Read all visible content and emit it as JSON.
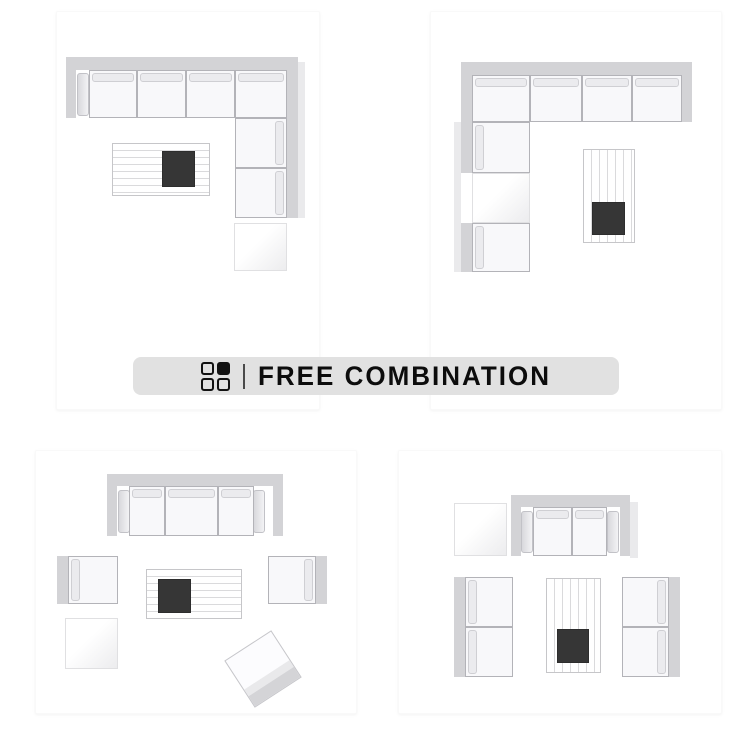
{
  "banner": {
    "label": "FREE COMBINATION",
    "icon": "grid-2x2-icon",
    "bg_color": "#e1e1e1",
    "text_color": "#0c0c0c"
  },
  "palette": {
    "sofa_band": "#d3d3d6",
    "seat_cushion": "#f8f8fa",
    "back_cushion": "#ebebee",
    "tray_dark": "#363636",
    "table_line": "#dadadc",
    "shadow": "#eaeaec"
  },
  "layouts": [
    {
      "id": "layout-top-left",
      "description": "L-shaped sectional (chaise on right) with ottoman and slatted coffee table with dark tray",
      "pieces": [
        {
          "t": "band",
          "x": 66,
          "y": 57,
          "w": 232,
          "h": 13
        },
        {
          "t": "band",
          "x": 66,
          "y": 70,
          "w": 10,
          "h": 48
        },
        {
          "t": "band",
          "x": 287,
          "y": 70,
          "w": 11,
          "h": 148
        },
        {
          "t": "shadow",
          "x": 298,
          "y": 62,
          "w": 7,
          "h": 156
        },
        {
          "t": "arm",
          "x": 77,
          "y": 73,
          "w": 12,
          "h": 43
        },
        {
          "t": "seat",
          "b": "t",
          "x": 89,
          "y": 70,
          "w": 48,
          "h": 48
        },
        {
          "t": "seat",
          "b": "t",
          "x": 137,
          "y": 70,
          "w": 49,
          "h": 48
        },
        {
          "t": "seat",
          "b": "t",
          "x": 186,
          "y": 70,
          "w": 49,
          "h": 48
        },
        {
          "t": "seat",
          "b": "t",
          "x": 235,
          "y": 70,
          "w": 52,
          "h": 48
        },
        {
          "t": "seat",
          "b": "r",
          "x": 235,
          "y": 118,
          "w": 52,
          "h": 50
        },
        {
          "t": "seat",
          "b": "r",
          "x": 235,
          "y": 168,
          "w": 52,
          "h": 50
        },
        {
          "t": "ottoman",
          "x": 234,
          "y": 223,
          "w": 53,
          "h": 48
        },
        {
          "t": "tableh",
          "x": 112,
          "y": 143,
          "w": 98,
          "h": 53
        },
        {
          "t": "tray",
          "x": 162,
          "y": 151,
          "w": 33,
          "h": 36
        }
      ]
    },
    {
      "id": "layout-top-right",
      "description": "Mirrored L-shaped sectional (chaise on left) with inset ottoman and vertical-slat table with dark tray",
      "pieces": [
        {
          "t": "band",
          "x": 461,
          "y": 62,
          "w": 231,
          "h": 13
        },
        {
          "t": "band",
          "x": 682,
          "y": 75,
          "w": 10,
          "h": 47
        },
        {
          "t": "band",
          "x": 461,
          "y": 75,
          "w": 11,
          "h": 98
        },
        {
          "t": "band",
          "x": 461,
          "y": 223,
          "w": 11,
          "h": 49
        },
        {
          "t": "shadow",
          "x": 454,
          "y": 122,
          "w": 7,
          "h": 150
        },
        {
          "t": "arm",
          "x": 668,
          "y": 80,
          "w": 12,
          "h": 40
        },
        {
          "t": "seat",
          "b": "t",
          "x": 472,
          "y": 75,
          "w": 58,
          "h": 47
        },
        {
          "t": "seat",
          "b": "t",
          "x": 530,
          "y": 75,
          "w": 52,
          "h": 47
        },
        {
          "t": "seat",
          "b": "t",
          "x": 582,
          "y": 75,
          "w": 50,
          "h": 47
        },
        {
          "t": "seat",
          "b": "t",
          "x": 632,
          "y": 75,
          "w": 50,
          "h": 47
        },
        {
          "t": "seat",
          "b": "l",
          "x": 472,
          "y": 122,
          "w": 58,
          "h": 51
        },
        {
          "t": "ottoman",
          "x": 472,
          "y": 173,
          "w": 58,
          "h": 50
        },
        {
          "t": "seat",
          "b": "l",
          "x": 472,
          "y": 223,
          "w": 58,
          "h": 49
        },
        {
          "t": "tablev",
          "x": 583,
          "y": 149,
          "w": 52,
          "h": 94
        },
        {
          "t": "tray",
          "x": 592,
          "y": 202,
          "w": 33,
          "h": 33
        }
      ]
    },
    {
      "id": "layout-bottom-left",
      "description": "Three-seat sofa with two facing armchairs, ottoman, rotated accent chair and slatted coffee table",
      "pieces": [
        {
          "t": "band",
          "x": 107,
          "y": 474,
          "w": 176,
          "h": 12
        },
        {
          "t": "band",
          "x": 107,
          "y": 486,
          "w": 10,
          "h": 50
        },
        {
          "t": "band",
          "x": 273,
          "y": 486,
          "w": 10,
          "h": 50
        },
        {
          "t": "arm",
          "x": 118,
          "y": 490,
          "w": 12,
          "h": 43
        },
        {
          "t": "arm",
          "x": 253,
          "y": 490,
          "w": 12,
          "h": 43
        },
        {
          "t": "seat",
          "b": "t",
          "x": 129,
          "y": 486,
          "w": 36,
          "h": 50
        },
        {
          "t": "seat",
          "b": "t",
          "x": 165,
          "y": 486,
          "w": 53,
          "h": 50
        },
        {
          "t": "seat",
          "b": "t",
          "x": 218,
          "y": 486,
          "w": 36,
          "h": 50
        },
        {
          "t": "band",
          "x": 57,
          "y": 556,
          "w": 11,
          "h": 48
        },
        {
          "t": "seat",
          "b": "l",
          "x": 68,
          "y": 556,
          "w": 50,
          "h": 48
        },
        {
          "t": "seat",
          "b": "r",
          "x": 268,
          "y": 556,
          "w": 48,
          "h": 48
        },
        {
          "t": "band",
          "x": 316,
          "y": 556,
          "w": 11,
          "h": 48
        },
        {
          "t": "tableh",
          "x": 146,
          "y": 569,
          "w": 96,
          "h": 50
        },
        {
          "t": "tray",
          "x": 158,
          "y": 579,
          "w": 33,
          "h": 34
        },
        {
          "t": "ottoman",
          "x": 65,
          "y": 618,
          "w": 53,
          "h": 51
        },
        {
          "t": "chairrot",
          "x": 235,
          "y": 641,
          "w": 56,
          "h": 56,
          "r": -33
        }
      ]
    },
    {
      "id": "layout-bottom-right",
      "description": "Loveseat with two facing two-seat sofas, ottoman and vertical-slat rug table with dark tray",
      "pieces": [
        {
          "t": "ottoman",
          "x": 454,
          "y": 503,
          "w": 53,
          "h": 53
        },
        {
          "t": "band",
          "x": 511,
          "y": 495,
          "w": 119,
          "h": 12
        },
        {
          "t": "band",
          "x": 511,
          "y": 507,
          "w": 10,
          "h": 49
        },
        {
          "t": "band",
          "x": 620,
          "y": 507,
          "w": 10,
          "h": 49
        },
        {
          "t": "shadow",
          "x": 630,
          "y": 502,
          "w": 8,
          "h": 56
        },
        {
          "t": "arm",
          "x": 521,
          "y": 511,
          "w": 12,
          "h": 42
        },
        {
          "t": "arm",
          "x": 607,
          "y": 511,
          "w": 12,
          "h": 42
        },
        {
          "t": "seat",
          "b": "t",
          "x": 533,
          "y": 507,
          "w": 39,
          "h": 49
        },
        {
          "t": "seat",
          "b": "t",
          "x": 572,
          "y": 507,
          "w": 35,
          "h": 49
        },
        {
          "t": "band",
          "x": 454,
          "y": 577,
          "w": 11,
          "h": 100
        },
        {
          "t": "seat",
          "b": "l",
          "x": 465,
          "y": 577,
          "w": 48,
          "h": 50
        },
        {
          "t": "seat",
          "b": "l",
          "x": 465,
          "y": 627,
          "w": 48,
          "h": 50
        },
        {
          "t": "band",
          "x": 669,
          "y": 577,
          "w": 11,
          "h": 100
        },
        {
          "t": "seat",
          "b": "r",
          "x": 622,
          "y": 577,
          "w": 47,
          "h": 50
        },
        {
          "t": "seat",
          "b": "r",
          "x": 622,
          "y": 627,
          "w": 47,
          "h": 50
        },
        {
          "t": "tablev",
          "x": 546,
          "y": 578,
          "w": 55,
          "h": 95
        },
        {
          "t": "tray",
          "x": 557,
          "y": 629,
          "w": 32,
          "h": 34
        }
      ]
    }
  ]
}
